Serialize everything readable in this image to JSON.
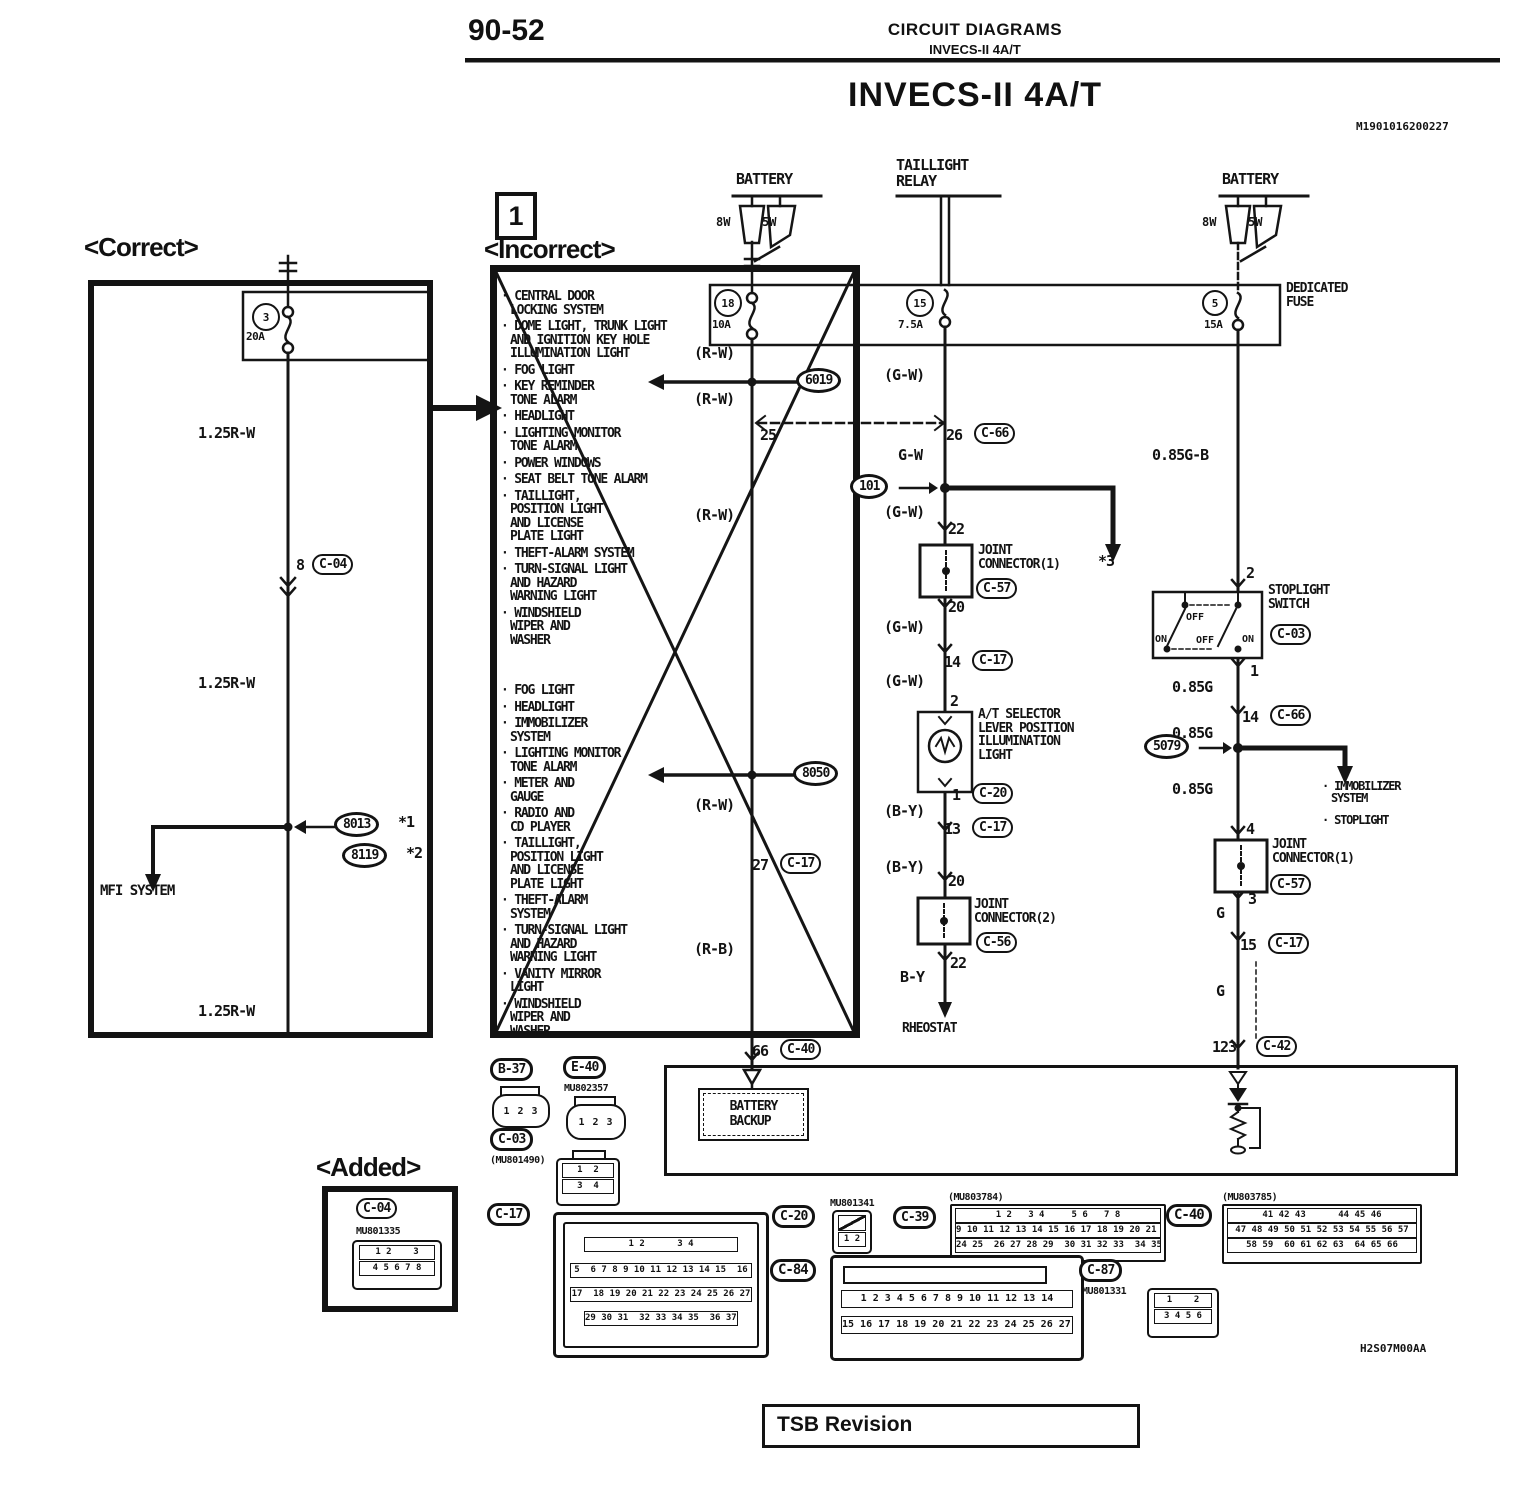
{
  "header": {
    "page_number": "90-52",
    "section_title": "CIRCUIT DIAGRAMS",
    "section_subtitle": "INVECS-II 4A/T",
    "diagram_title": "INVECS-II 4A/T",
    "doc_code": "M1901016200227",
    "footer_code": "H2S07M00AA",
    "tsb_label": "TSB Revision"
  },
  "correct": {
    "heading": "<Correct>",
    "fuse_num": "3",
    "fuse_amp": "20A",
    "wire1": "1.25R-W",
    "wire2": "1.25R-W",
    "wire3": "1.25R-W",
    "pin8": "8",
    "c04": "C-04",
    "s8013": "8013",
    "note1": "*1",
    "s8119": "8119",
    "note2": "*2",
    "mfi": "MFI SYSTEM"
  },
  "incorrect": {
    "marker": "1",
    "heading": "<Incorrect>",
    "items_top": [
      "CENTRAL DOOR\nLOCKING SYSTEM",
      "DOME LIGHT, TRUNK LIGHT\nAND IGNITION KEY HOLE\nILLUMINATION LIGHT",
      "FOG LIGHT",
      "KEY REMINDER\nTONE ALARM",
      "HEADLIGHT",
      "LIGHTING MONITOR\nTONE ALARM",
      "POWER WINDOWS",
      "SEAT BELT TONE ALARM",
      "TAILLIGHT,\nPOSITION LIGHT\nAND LICENSE\nPLATE LIGHT",
      "THEFT-ALARM SYSTEM",
      "TURN-SIGNAL LIGHT\nAND HAZARD\nWARNING LIGHT",
      "WINDSHIELD\nWIPER AND\nWASHER"
    ],
    "items_bottom": [
      "FOG LIGHT",
      "HEADLIGHT",
      "IMMOBILIZER\nSYSTEM",
      "LIGHTING MONITOR\nTONE ALARM",
      "METER AND\nGAUGE",
      "RADIO AND\nCD PLAYER",
      "TAILLIGHT,\nPOSITION LIGHT\nAND LICENSE\nPLATE LIGHT",
      "THEFT-ALARM\nSYSTEM",
      "TURN-SIGNAL LIGHT\nAND HAZARD\nWARNING LIGHT",
      "VANITY MIRROR\nLIGHT",
      "WINDSHIELD\nWIPER AND\nWASHER"
    ],
    "rw1": "(R-W)",
    "rw2": "(R-W)",
    "rw3": "(R-W)",
    "rw4": "(R-W)",
    "rb": "(R-B)",
    "pin25": "25",
    "pin27": "27",
    "c17": "C-17",
    "pin66": "66",
    "c40": "C-40",
    "s6019": "6019",
    "s8050": "8050"
  },
  "power": {
    "battery1": "BATTERY",
    "battery2": "BATTERY",
    "relay": "TAILLIGHT\nRELAY",
    "bulb_8w": "8W",
    "bulb_5w": "5W",
    "bulb_8w2": "8W",
    "bulb_5w2": "5W",
    "dedicated": "DEDICATED\nFUSE",
    "f18": "18",
    "f18a": "10A",
    "f15": "15",
    "f15a": "7.5A",
    "f5": "5",
    "f5a": "15A"
  },
  "mid": {
    "gw1": "(G-W)",
    "pin26": "26",
    "c66": "C-66",
    "gw2": "G-W",
    "s101": "101",
    "star3": "*3",
    "gw3": "(G-W)",
    "pin22": "22",
    "jc1": "JOINT\nCONNECTOR(1)",
    "c57": "C-57",
    "pin20": "20",
    "gw4": "(G-W)",
    "pin14": "14",
    "c17a": "C-17",
    "gw5": "(G-W)",
    "pin2": "2",
    "at_label": "A/T SELECTOR\nLEVER POSITION\nILLUMINATION\nLIGHT",
    "pin1": "1",
    "c20": "C-20",
    "by1": "(B-Y)",
    "pin13": "13",
    "c17b": "C-17",
    "by2": "(B-Y)",
    "pin20b": "20",
    "jc2": "JOINT\nCONNECTOR(2)",
    "c56": "C-56",
    "pin22b": "22",
    "by3": "B-Y",
    "rheostat": "RHEOSTAT"
  },
  "right": {
    "gb": "0.85G-B",
    "pin2": "2",
    "stop_label": "STOPLIGHT\nSWITCH",
    "c03": "C-03",
    "on1": "ON",
    "off1": "OFF",
    "off2": "OFF",
    "on2": "ON",
    "pin1": "1",
    "g1": "0.85G",
    "pin14": "14",
    "c66": "C-66",
    "g2": "0.85G",
    "s5079": "5079",
    "g3": "0.85G",
    "imm1": "IMMOBILIZER\nSYSTEM",
    "imm2": "STOPLIGHT",
    "pin4": "4",
    "jc1": "JOINT\nCONNECTOR(1)",
    "c57": "C-57",
    "pin3": "3",
    "g4": "G",
    "pin15": "15",
    "c17": "C-17",
    "g5": "G",
    "pin123": "123",
    "c42": "C-42"
  },
  "bottom": {
    "backup": "BATTERY\nBACKUP",
    "added_heading": "<Added>",
    "b37": "B-37",
    "pins_b37": "1 2 3",
    "e40": "E-40",
    "mu_e40": "MU802357",
    "pins_e40": "1 2 3",
    "c03": "C-03",
    "mu_c03": "(MU801490)",
    "c03_r1": "1  2",
    "c03_r2": "3  4",
    "c17": "C-17",
    "c17_r1": "1 2      3 4",
    "c17_r2": "5  6 7 8 9 10 11 12 13 14 15  16",
    "c17_r3": "17  18 19 20 21 22 23 24 25 26 27",
    "c17_r4": "29 30 31  32 33 34 35  36 37 38",
    "c04": "C-04",
    "mu_c04": "MU801335",
    "c04_r1": "1 2    3",
    "c04_r2": "4 5 6 7 8",
    "c20": "C-20",
    "mu_c20": "MU801341",
    "c20_r1": "1 2",
    "c39": "C-39",
    "mu_c39": "(MU803784)",
    "c39_r1": "1 2   3 4     5 6   7 8",
    "c39_r2": "9 10 11 12 13 14 15 16 17 18 19 20 21 22 23",
    "c39_r3": "24 25  26 27 28 29  30 31 32 33  34 35",
    "c40": "C-40",
    "mu_c40": "(MU803785)",
    "c40_r1": "41 42 43      44 45 46",
    "c40_r2": "47 48 49 50 51 52 53 54 55 56 57",
    "c40_r3": "58 59  60 61 62 63  64 65 66",
    "c84": "C-84",
    "c84_r1": "1 2 3 4 5 6 7 8 9 10 11 12 13 14",
    "c84_r2": "15 16 17 18 19 20 21 22 23 24 25 26 27 28",
    "c87": "C-87",
    "mu_c87": "MU801331",
    "c87_r1": "1    2",
    "c87_r2": "3 4 5 6"
  }
}
